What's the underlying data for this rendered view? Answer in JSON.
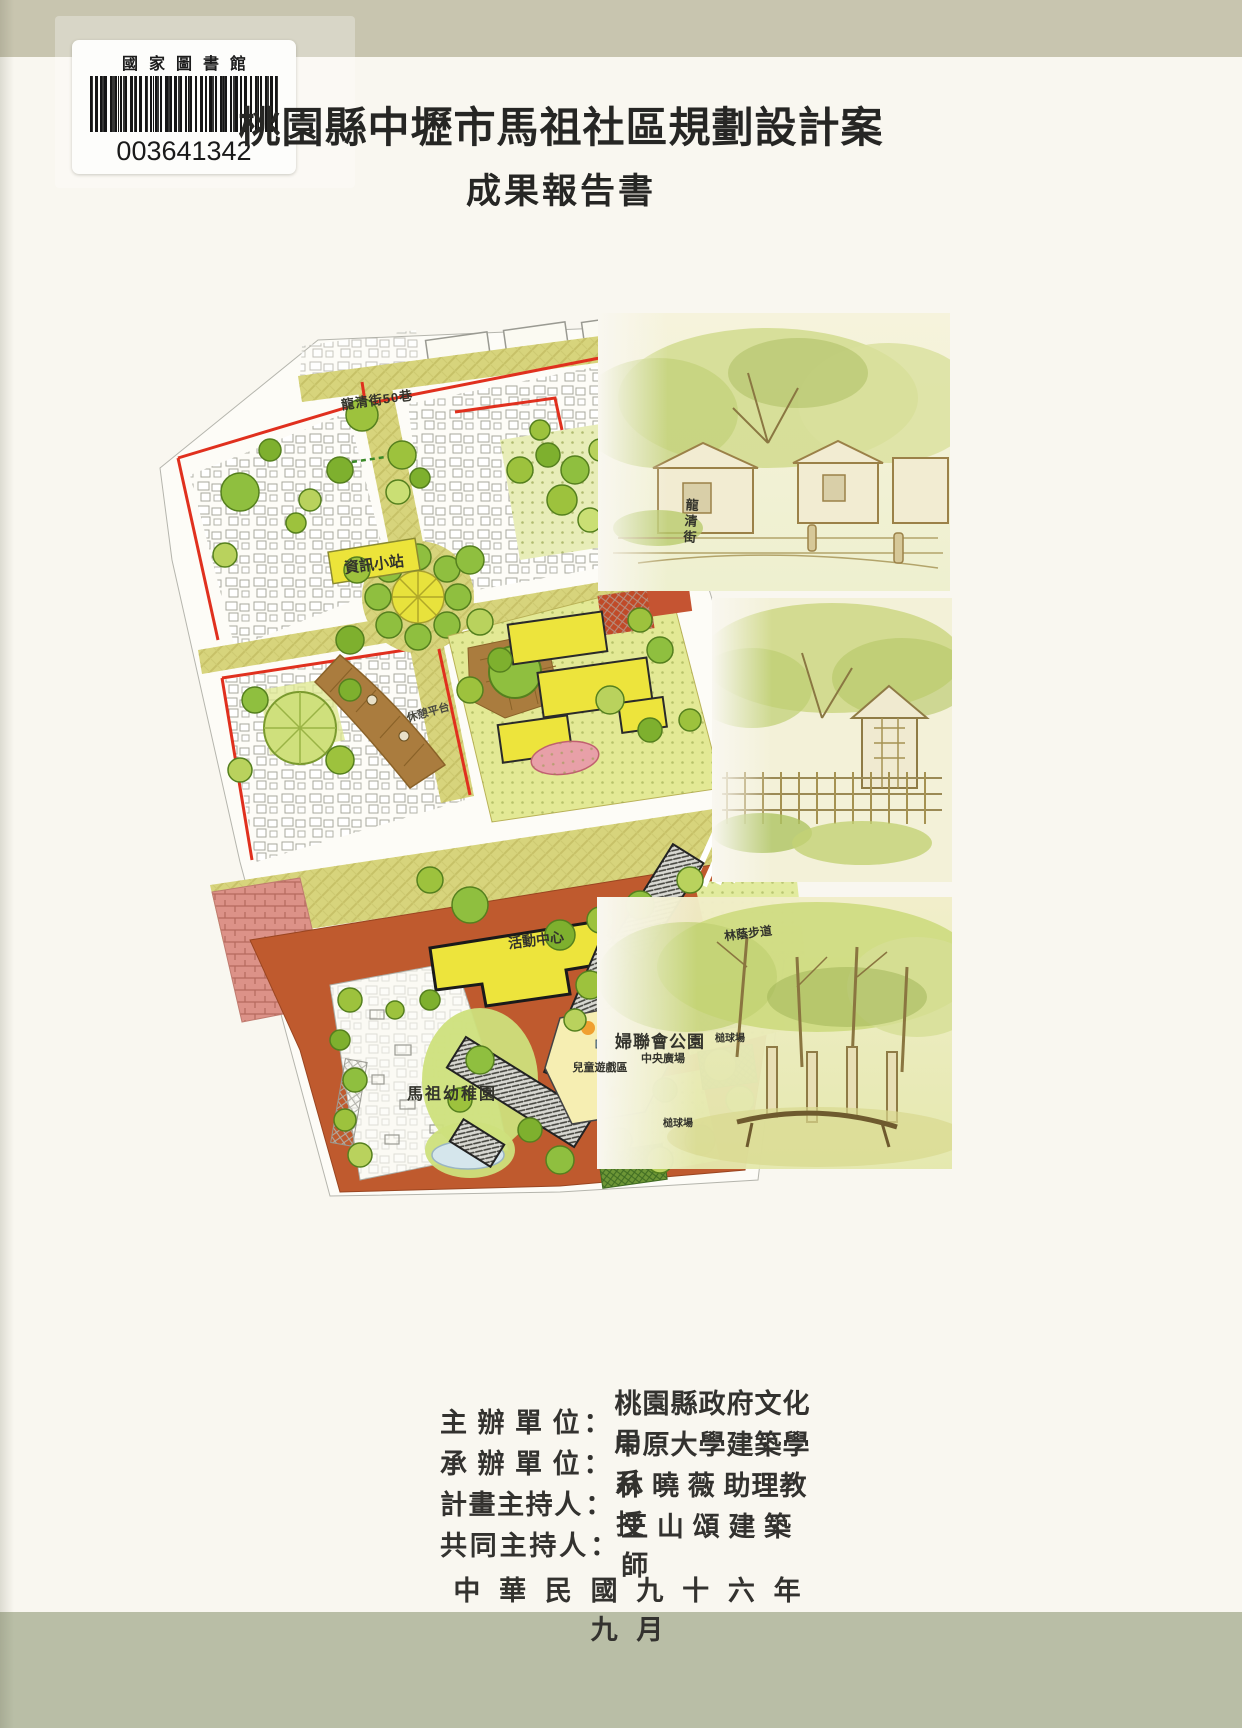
{
  "library_label": {
    "institution": "國家圖書館",
    "barcode_number": "003641342"
  },
  "title": "桃園縣中壢市馬祖社區規劃設計案",
  "subtitle": "成果報告書",
  "site_plan": {
    "labels": {
      "street_top": "龍清街50巷",
      "street_right": "龍清街",
      "info_station": "資訊小站",
      "rest_deck": "休憩平台",
      "activity_center": "活動中心",
      "shaded_walk": "林蔭步道",
      "kindergarten": "馬祖幼稚園",
      "children_play_area": "兒童遊戲區",
      "womens_league_park": "婦聯會公園",
      "central_plaza": "中央廣場",
      "croquet_court_upper": "槌球場",
      "croquet_court_lower": "槌球場"
    }
  },
  "credits": {
    "separator": "：",
    "rows": [
      {
        "label": "主 辦 單 位",
        "value": "桃園縣政府文化局"
      },
      {
        "label": "承 辦 單 位",
        "value": "中原大學建築學系"
      },
      {
        "label": "計畫主持人",
        "value": "林 曉 薇 助理教授"
      },
      {
        "label": "共同主持人",
        "value": "王 山 頌 建 築 師"
      }
    ],
    "date_line": "中 華 民 國 九 十 六 年 九 月"
  },
  "colors": {
    "cover_band_top": "#c8c5af",
    "cover_band_bottom": "#b9bea6",
    "boundary_red": "#e0301e",
    "street_khaki": "#d7d47c",
    "building_yellow": "#ede43c",
    "park_terracotta": "#bf5a2e",
    "tree_green": "#9dc23d"
  }
}
